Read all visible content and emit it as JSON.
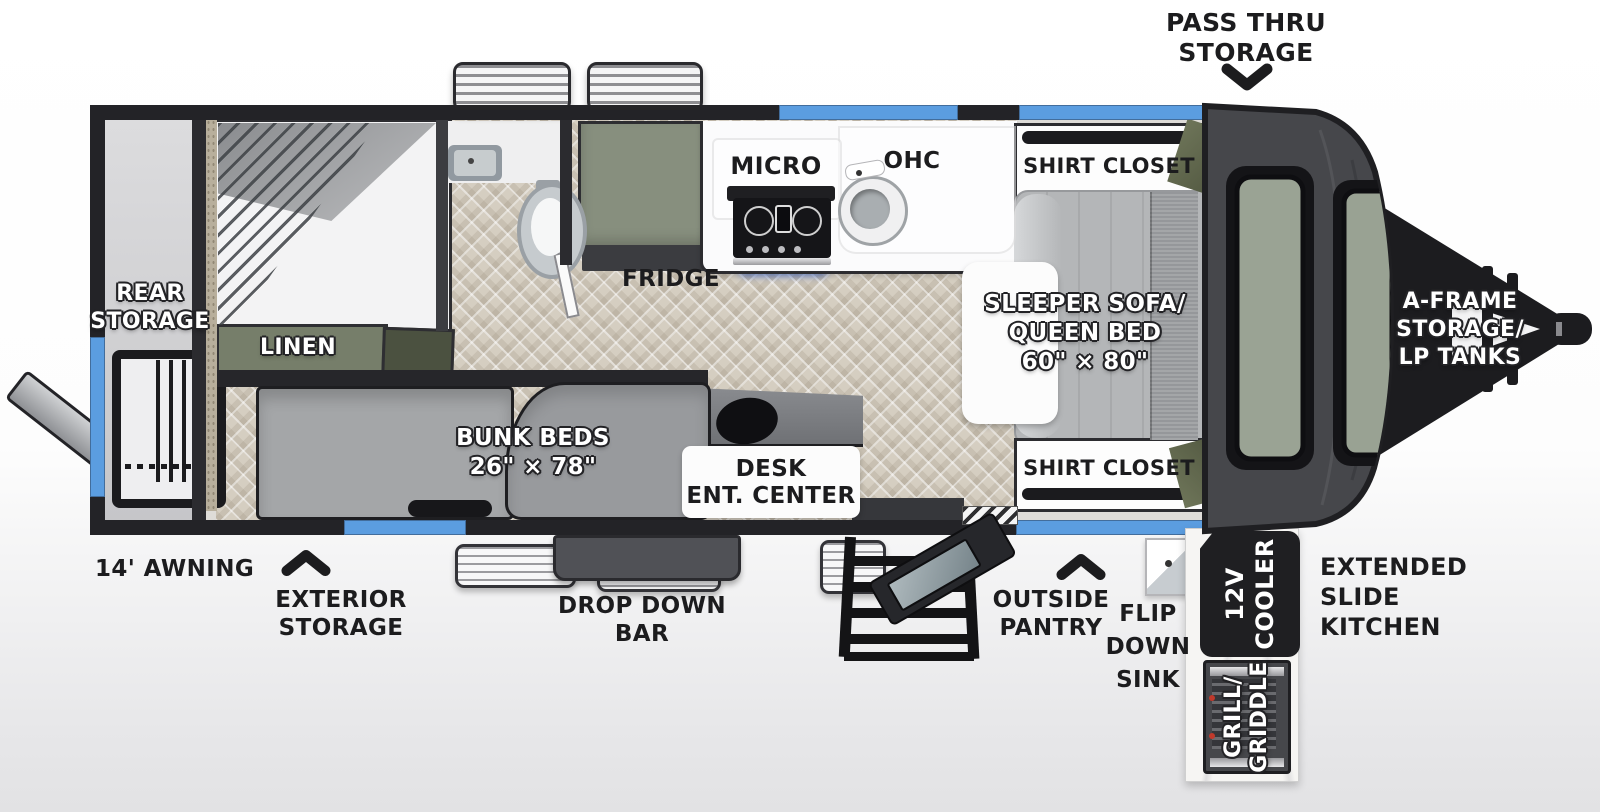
{
  "fp": {
    "pass_thru": [
      "PASS THRU",
      "STORAGE"
    ],
    "rear_storage": [
      "REAR",
      "STORAGE"
    ],
    "linen": "LINEN",
    "fridge": "FRIDGE",
    "micro": "MICRO",
    "ohc": "OHC",
    "closet_top": "SHIRT CLOSET",
    "closet_bottom": "SHIRT CLOSET",
    "sleeper": [
      "SLEEPER SOFA/",
      "QUEEN BED",
      "60\" × 80\""
    ],
    "bunks": [
      "BUNK BEDS",
      "26\" × 78\""
    ],
    "desk": [
      "DESK",
      "ENT. CENTER"
    ],
    "aframe": [
      "A-FRAME",
      "STORAGE/",
      "LP TANKS"
    ],
    "awning": "14' AWNING",
    "ext_storage": [
      "EXTERIOR",
      "STORAGE"
    ],
    "drop_bar": [
      "DROP DOWN",
      "BAR"
    ],
    "pantry": [
      "OUTSIDE",
      "PANTRY"
    ],
    "flip_sink": [
      "FLIP",
      "DOWN",
      "SINK"
    ],
    "cooler": [
      "12V",
      "COOLER"
    ],
    "slide_kitchen": [
      "EXTENDED",
      "SLIDE",
      "KITCHEN"
    ],
    "grill": [
      "GRILL/",
      "GRIDDLE"
    ],
    "colors": {
      "wall": "#232327",
      "window_blue": "#5b9de0",
      "cabinet_green": "#868e7d",
      "clothes_green": "#646b50",
      "furniture_gray": "#a9abad",
      "floor_tile": "#d5cec1",
      "stove_glow_blue": "#4a78e8"
    }
  }
}
